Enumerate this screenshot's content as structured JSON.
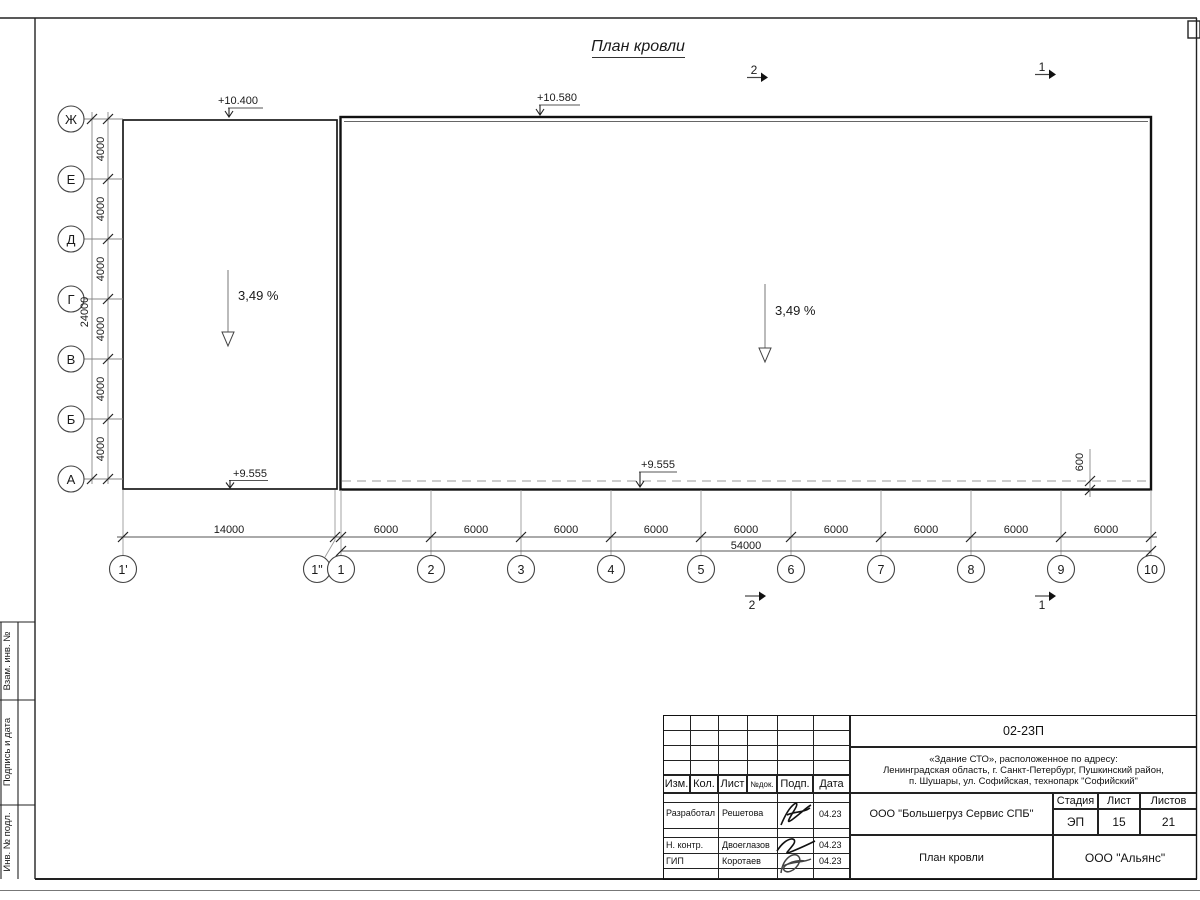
{
  "sheet": {
    "title": "План кровли",
    "corner_box": ""
  },
  "plan": {
    "row_axes": [
      "Ж",
      "Е",
      "Д",
      "Г",
      "В",
      "Б",
      "А"
    ],
    "col_axes": [
      "1'",
      "1\"",
      "1",
      "2",
      "3",
      "4",
      "5",
      "6",
      "7",
      "8",
      "9",
      "10"
    ],
    "dim_left_segment": "4000",
    "dim_left_total": "24000",
    "dim_bottom_first": "14000",
    "dim_bottom_segment": "6000",
    "dim_bottom_total": "54000",
    "dim_overhang": "600",
    "elevation_left": "+10.400",
    "elevation_right": "+10.580",
    "elevation_bottom_left": "+9.555",
    "elevation_bottom_mid": "+9.555",
    "slope_left": "3,49 %",
    "slope_right": "3,49 %",
    "section_mark_1": "1",
    "section_mark_2": "2"
  },
  "title_block": {
    "code": "02-23П",
    "object_line1": "«Здание СТО», расположенное по адресу:",
    "object_line2": "Ленинградская область, г. Санкт-Петербург, Пушкинский район,",
    "object_line3": "п. Шушары, ул. Софийская, технопарк \"Софийский\"",
    "headers": [
      "Изм.",
      "Кол.",
      "Лист",
      "№док.",
      "Подп.",
      "Дата"
    ],
    "rows": [
      {
        "role": "Разработал",
        "name": "Решетова",
        "date": "04.23"
      },
      {
        "role": "Н. контр.",
        "name": "Двоеглазов",
        "date": "04.23"
      },
      {
        "role": "ГИП",
        "name": "Коротаев",
        "date": "04.23"
      }
    ],
    "company": "ООО \"Большегруз Сервис СПБ\"",
    "drawing_name": "План кровли",
    "firm": "ООО \"Альянс\"",
    "stage_label": "Стадия",
    "sheet_label": "Лист",
    "sheets_label": "Листов",
    "stage": "ЭП",
    "sheet_no": "15",
    "sheets_total": "21"
  },
  "side_column": [
    "Взам. инв. №",
    "Подпись и дата",
    "Инв. № подл."
  ]
}
